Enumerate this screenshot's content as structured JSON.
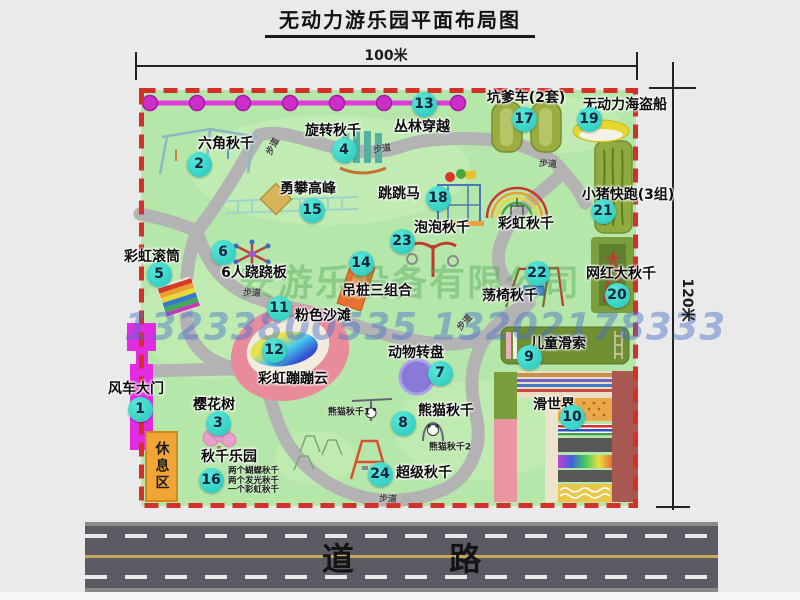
{
  "page": {
    "title": "无动力游乐园平面布局图"
  },
  "dimensions": {
    "top": "100米",
    "right": "120米"
  },
  "road": {
    "label": "道  路"
  },
  "watermark": {
    "company": "安游乐设备有限公司",
    "phone": "13233800535 13202178333"
  },
  "labels": {
    "walkway": "步道",
    "rainbow_swing": "彩虹秋千",
    "rest_area": "休息区"
  },
  "notes": {
    "swing_park": [
      "两个蝴蝶秋千",
      "两个发光秋千",
      "一个彩虹秋千"
    ],
    "panda1": "熊猫秋千1",
    "panda2": "熊猫秋千2"
  },
  "attractions": [
    {
      "num": "1",
      "name": "风车大门"
    },
    {
      "num": "2",
      "name": "六角秋千"
    },
    {
      "num": "3",
      "name": "樱花树"
    },
    {
      "num": "4",
      "name": "旋转秋千"
    },
    {
      "num": "5",
      "name": "彩虹滚筒"
    },
    {
      "num": "6",
      "name": "6人跷跷板"
    },
    {
      "num": "7",
      "name": "动物转盘"
    },
    {
      "num": "8",
      "name": "熊猫秋千"
    },
    {
      "num": "9",
      "name": "儿童滑索"
    },
    {
      "num": "10",
      "name": "滑世界"
    },
    {
      "num": "11",
      "name": "粉色沙滩"
    },
    {
      "num": "12",
      "name": "彩虹蹦蹦云"
    },
    {
      "num": "13",
      "name": "丛林穿越"
    },
    {
      "num": "14",
      "name": "吊桩三组合"
    },
    {
      "num": "15",
      "name": "勇攀高峰"
    },
    {
      "num": "16",
      "name": "秋千乐园"
    },
    {
      "num": "17",
      "name": "坑爹车(2套)"
    },
    {
      "num": "18",
      "name": "跳跳马"
    },
    {
      "num": "19",
      "name": "无动力海盗船"
    },
    {
      "num": "20",
      "name": "网红大秋千"
    },
    {
      "num": "21",
      "name": "小猪快跑(3组)"
    },
    {
      "num": "22",
      "name": "荡椅秋千"
    },
    {
      "num": "23",
      "name": "泡泡秋千"
    },
    {
      "num": "24",
      "name": "超级秋千"
    }
  ],
  "colors": {
    "map_green": "#b6e7aa",
    "border_red": "#d23028",
    "path_gray": "#b3b3b3",
    "badge_teal": "#2cc8bc",
    "gate_magenta": "#e22ce2",
    "rest_orange": "#f2a536",
    "road_gray": "#5b5b63"
  }
}
